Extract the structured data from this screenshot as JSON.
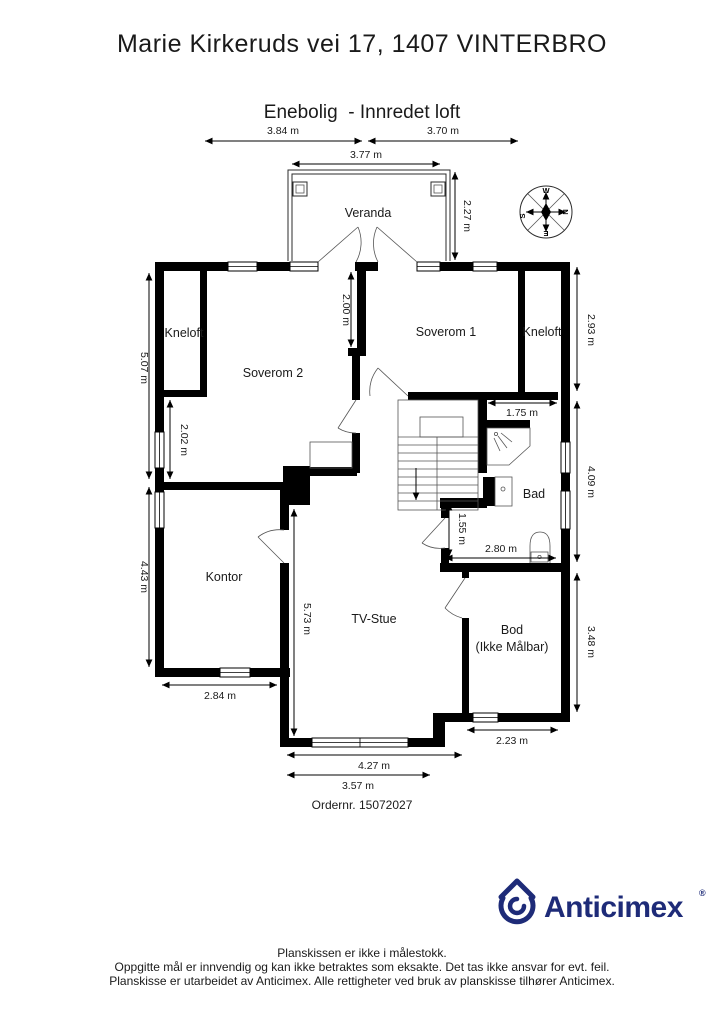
{
  "header": {
    "title": "Marie Kirkeruds vei 17, 1407 VINTERBRO",
    "subtitle": "Enebolig  - Innredet loft"
  },
  "rooms": {
    "veranda": "Veranda",
    "kneloft_left": "Kneloft",
    "soverom2": "Soverom 2",
    "soverom1": "Soverom 1",
    "kneloft_right": "Kneloft",
    "bad": "Bad",
    "kontor": "Kontor",
    "tvstue": "TV-Stue",
    "bod_line1": "Bod",
    "bod_line2": "(Ikke Målbar)"
  },
  "dims": {
    "top_left": "3.84 m",
    "top_right": "3.70 m",
    "veranda_w": "3.77 m",
    "veranda_h": "2.27 m",
    "left_upper": "5.07 m",
    "kneloft_gap": "2.02 m",
    "left_lower": "4.43 m",
    "wall_a": "2.00 m",
    "right_upper": "2.93 m",
    "right_mid": "4.09 m",
    "right_lower": "3.48 m",
    "bad_top": "1.75 m",
    "bad_left": "1.55 m",
    "bad_bottom": "2.80 m",
    "tv_left": "5.73 m",
    "kontor_bottom": "2.84 m",
    "bod_bottom": "2.23 m",
    "tv_bottom": "4.27 m",
    "tv_bottom2": "3.57 m"
  },
  "compass": {
    "n": "N",
    "e": "E",
    "s": "S",
    "w": "W"
  },
  "order": {
    "label": "Ordernr. 15072027"
  },
  "logo": {
    "name": "Anticimex",
    "reg": "®",
    "color": "#1e2b78"
  },
  "footer": {
    "line1": "Planskissen er ikke i målestokk.",
    "line2": "Oppgitte mål er innvendig og kan ikke betraktes som eksakte. Det tas ikke ansvar for evt. feil.",
    "line3": "Planskisse er utarbeidet av Anticimex. Alle rettigheter ved bruk av planskisse tilhører Anticimex."
  }
}
